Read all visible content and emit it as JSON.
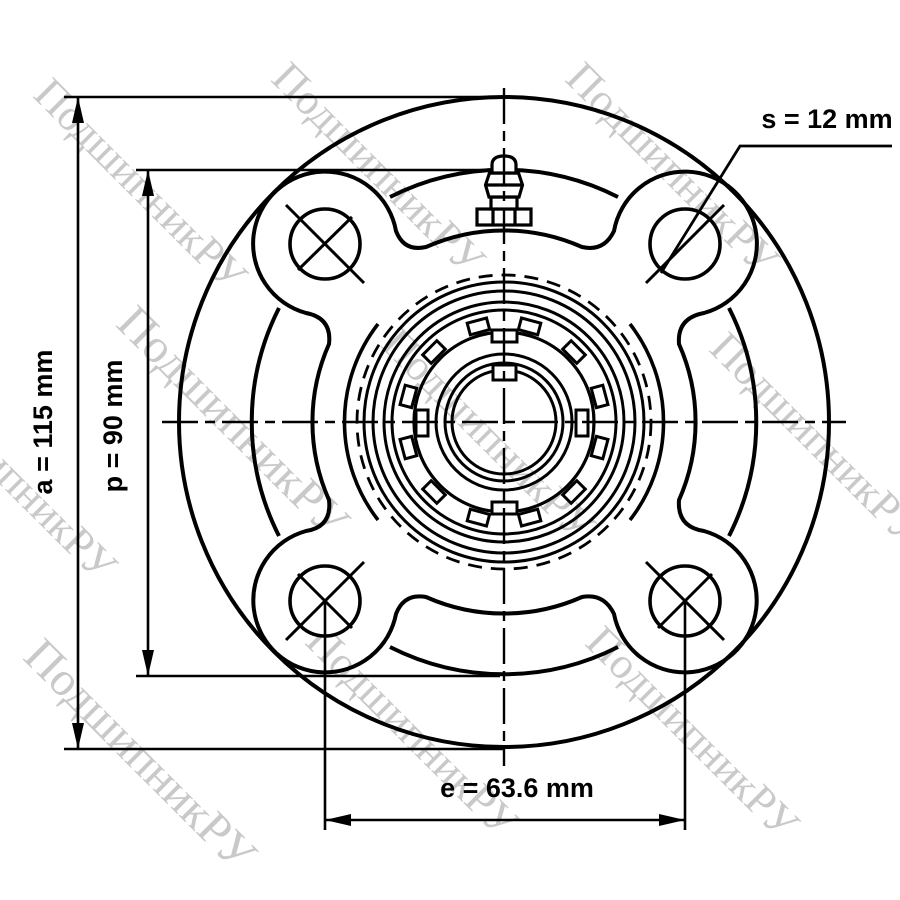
{
  "drawing": {
    "title": "Flange bearing unit front view",
    "dimensions": {
      "a": {
        "label": "a = 115 mm",
        "name": "a",
        "value": "115",
        "unit": "mm"
      },
      "p": {
        "label": "p = 90 mm",
        "name": "p",
        "value": "90",
        "unit": "mm"
      },
      "e": {
        "label": "e = 63.6 mm",
        "name": "e",
        "value": "63.6",
        "unit": "mm"
      },
      "s": {
        "label": "s = 12 mm",
        "name": "s",
        "value": "12",
        "unit": "mm"
      }
    },
    "watermark": {
      "text": "ПодшипникРУ",
      "color": "#c9c9c9"
    },
    "colors": {
      "line": "#000000",
      "background": "#ffffff"
    },
    "features": {
      "bolt_holes": 4,
      "grease_fitting": "top-center",
      "locking_tabs": 12
    }
  }
}
